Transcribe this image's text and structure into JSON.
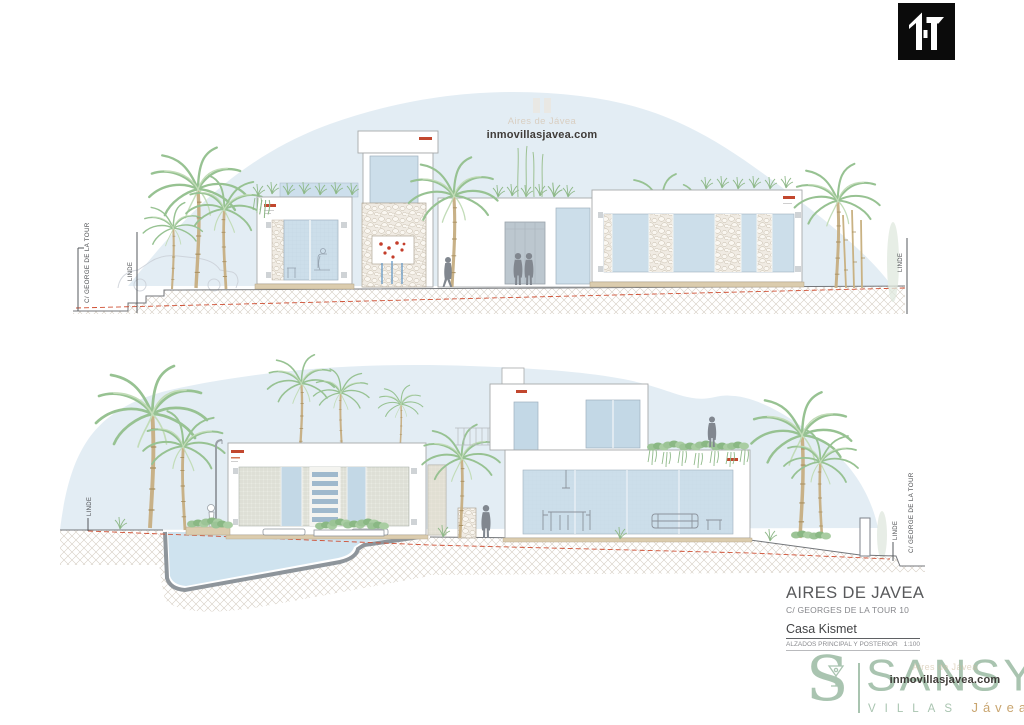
{
  "watermarks": {
    "center": {
      "brand": "Aires de Jávea",
      "site": "inmovillasjavea.com"
    },
    "bottom": {
      "brand": "Aires de Jávea",
      "site": "inmovillasjavea.com"
    }
  },
  "drawing_labels": {
    "street": "C/ GEORGE DE LA TOUR",
    "boundary": "LINDE"
  },
  "title_block": {
    "project": "AIRES DE JAVEA",
    "address": "C/ GEORGES DE LA TOUR 10",
    "name": "Casa Kismet",
    "sheet": "ALZADOS PRINCIPAL Y POSTERIOR",
    "scale": "1:100"
  },
  "brand": {
    "monogram": "S",
    "wordmark": "SANSY",
    "tagline_left": "VILLAS",
    "tagline_right": "Jávea"
  },
  "colors": {
    "sky": "#e3edf4",
    "glass": "#ccdeea",
    "accent_red": "#c2472e",
    "boundary_red": "#cf4f33",
    "brand_green": "#a9c4b0",
    "brand_tan": "#c9a56f",
    "silhouette": "#81878f"
  }
}
